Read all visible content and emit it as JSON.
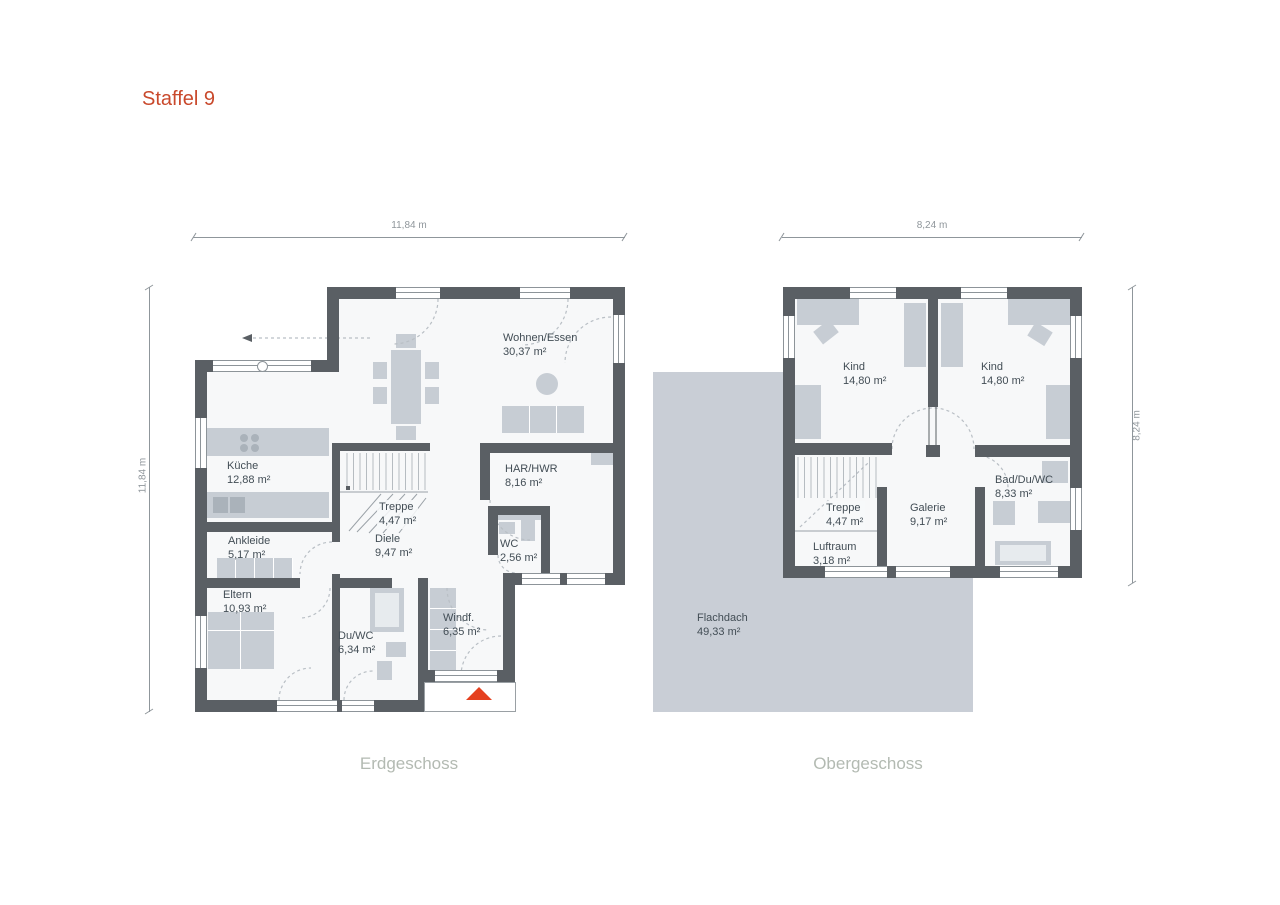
{
  "title": "Staffel 9",
  "eg": {
    "label": "Erdgeschoss",
    "dim_width": "11,84 m",
    "dim_height": "11,84 m",
    "rooms": {
      "wohnen": {
        "name": "Wohnen/Essen",
        "area": "30,37 m²"
      },
      "kueche": {
        "name": "Küche",
        "area": "12,88 m²"
      },
      "har": {
        "name": "HAR/HWR",
        "area": "8,16 m²"
      },
      "treppe": {
        "name": "Treppe",
        "area": "4,47 m²"
      },
      "diele": {
        "name": "Diele",
        "area": "9,47 m²"
      },
      "wc": {
        "name": "WC",
        "area": "2,56 m²"
      },
      "ankleide": {
        "name": "Ankleide",
        "area": "5,17 m²"
      },
      "eltern": {
        "name": "Eltern",
        "area": "10,93 m²"
      },
      "duwc": {
        "name": "Du/WC",
        "area": "6,34 m²"
      },
      "windf": {
        "name": "Windf.",
        "area": "6,35 m²"
      }
    }
  },
  "og": {
    "label": "Obergeschoss",
    "dim_width": "8,24 m",
    "dim_height": "8,24 m",
    "rooms": {
      "kind1": {
        "name": "Kind",
        "area": "14,80 m²"
      },
      "kind2": {
        "name": "Kind",
        "area": "14,80 m²"
      },
      "treppe": {
        "name": "Treppe",
        "area": "4,47 m²"
      },
      "galerie": {
        "name": "Galerie",
        "area": "9,17 m²"
      },
      "luftraum": {
        "name": "Luftraum",
        "area": "3,18 m²"
      },
      "bad": {
        "name": "Bad/Du/WC",
        "area": "8,33 m²"
      },
      "flachdach": {
        "name": "Flachdach",
        "area": "49,33 m²"
      }
    }
  },
  "colors": {
    "wall": "#5a5f64",
    "room": "#f7f8f9",
    "furniture": "#c7cdd4",
    "furniture_dark": "#aab2ba",
    "flat_roof": "#c9ced6",
    "accent": "#c9492c",
    "entrance_arrow": "#e5401f",
    "text": "#424d55",
    "dim": "#8f969b",
    "floor_label": "#b3bab2",
    "window_line": "#8d9499"
  }
}
